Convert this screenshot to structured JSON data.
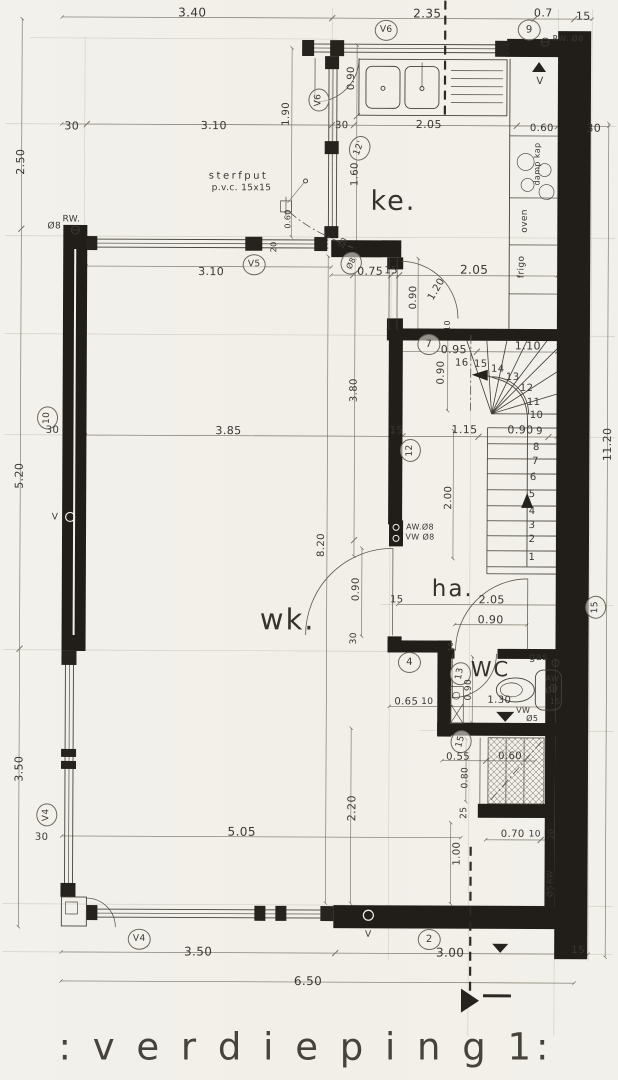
{
  "title": ": v e r d i e p i n g  1:",
  "colors": {
    "paper": "#f2f0ea",
    "ink": "#3a3734",
    "wall": "#211e1a",
    "dim": "#7a7468",
    "faint": "#b3ac9b",
    "line": "#45413a"
  },
  "plan": {
    "labels": [
      {
        "t": "3.40",
        "x": 190,
        "y": 13,
        "fs": 12
      },
      {
        "t": "2.35",
        "x": 425,
        "y": 13,
        "fs": 12
      },
      {
        "t": "0.7",
        "x": 541,
        "y": 12,
        "fs": 11
      },
      {
        "t": "15",
        "x": 581,
        "y": 15,
        "fs": 11
      },
      {
        "t": "9",
        "x": 527,
        "y": 29,
        "fs": 10,
        "c": true,
        "n": "ref-bubble-9"
      },
      {
        "t": "RW. Ø8",
        "x": 566,
        "y": 38,
        "fs": 8,
        "n": "rw-pipe-label"
      },
      {
        "t": "V6",
        "x": 384,
        "y": 30,
        "fs": 9,
        "c": true,
        "n": "window-tag-v6"
      },
      {
        "t": "V",
        "x": 538,
        "y": 81,
        "fs": 10,
        "n": "vent-label"
      },
      {
        "t": "0.90",
        "x": 350,
        "y": 78,
        "r": -90,
        "fs": 10
      },
      {
        "t": "V6",
        "x": 317,
        "y": 100,
        "r": -90,
        "fs": 9,
        "c": true,
        "n": "window-tag-v6"
      },
      {
        "t": "2.50",
        "x": 19,
        "y": 163,
        "r": -90,
        "fs": 11
      },
      {
        "t": "30",
        "x": 70,
        "y": 127,
        "fs": 11
      },
      {
        "t": "3.10",
        "x": 212,
        "y": 126,
        "fs": 11
      },
      {
        "t": "1.90",
        "x": 285,
        "y": 114,
        "r": -90,
        "fs": 10
      },
      {
        "t": "30",
        "x": 340,
        "y": 126,
        "fs": 10
      },
      {
        "t": "2.05",
        "x": 427,
        "y": 124,
        "fs": 11
      },
      {
        "t": "0.60",
        "x": 540,
        "y": 128,
        "fs": 10
      },
      {
        "t": "30",
        "x": 592,
        "y": 127,
        "fs": 11
      },
      {
        "t": "12'",
        "x": 358,
        "y": 148,
        "r": -70,
        "fs": 9,
        "c": true,
        "n": "ref-bubble-12"
      },
      {
        "t": "1.60",
        "x": 354,
        "y": 174,
        "r": -90,
        "fs": 10
      },
      {
        "t": "ke.",
        "x": 392,
        "y": 201,
        "fs": 27,
        "n": "room-label-ke",
        "cls": "room"
      },
      {
        "t": "damp kap",
        "x": 536,
        "y": 163,
        "r": -90,
        "fs": 8,
        "n": "appliance-dampkap"
      },
      {
        "t": "oven",
        "x": 524,
        "y": 220,
        "r": -90,
        "fs": 9,
        "n": "appliance-oven"
      },
      {
        "t": "frigo",
        "x": 521,
        "y": 266,
        "r": -90,
        "fs": 9,
        "n": "appliance-frigo"
      },
      {
        "t": "sterfput",
        "x": 237,
        "y": 177,
        "fs": 10,
        "cls": "sp",
        "n": "sterfput-label"
      },
      {
        "t": "p.v.c. 15x15",
        "x": 240,
        "y": 189,
        "fs": 9,
        "n": "sterfput-spec"
      },
      {
        "t": "RW.",
        "x": 70,
        "y": 221,
        "fs": 9,
        "n": "rw-pipe-label"
      },
      {
        "t": "Ø8",
        "x": 53,
        "y": 228,
        "fs": 9
      },
      {
        "t": "V5",
        "x": 253,
        "y": 265,
        "fs": 9,
        "c": true,
        "n": "window-tag-v5"
      },
      {
        "t": "3.10",
        "x": 210,
        "y": 272,
        "fs": 11
      },
      {
        "t": "0.60",
        "x": 287,
        "y": 219,
        "r": -90,
        "fs": 8
      },
      {
        "t": "20",
        "x": 273,
        "y": 247,
        "r": -90,
        "fs": 8
      },
      {
        "t": "20",
        "x": 342,
        "y": 243,
        "r": -65,
        "fs": 8
      },
      {
        "t": "Ø8",
        "x": 350,
        "y": 263,
        "r": -65,
        "fs": 8,
        "c": true,
        "n": "ref-bubble-o8"
      },
      {
        "t": "0.75",
        "x": 369,
        "y": 271,
        "fs": 11
      },
      {
        "t": "15",
        "x": 390,
        "y": 271,
        "fs": 10
      },
      {
        "t": "0.90",
        "x": 413,
        "y": 297,
        "r": -90,
        "fs": 10
      },
      {
        "t": "1.20",
        "x": 436,
        "y": 289,
        "r": -60,
        "fs": 10
      },
      {
        "t": "2.05",
        "x": 473,
        "y": 269,
        "fs": 12
      },
      {
        "t": "10",
        "x": 447,
        "y": 325,
        "r": -90,
        "fs": 8
      },
      {
        "t": "7",
        "x": 428,
        "y": 344,
        "fs": 10,
        "c": true,
        "n": "ref-bubble-7"
      },
      {
        "t": "0.95",
        "x": 453,
        "y": 349,
        "fs": 11
      },
      {
        "t": "1.10",
        "x": 527,
        "y": 345,
        "fs": 11
      },
      {
        "t": "16",
        "x": 461,
        "y": 363,
        "fs": 10,
        "n": "stair-step-number"
      },
      {
        "t": "15",
        "x": 480,
        "y": 364,
        "fs": 10,
        "n": "stair-step-number"
      },
      {
        "t": "14",
        "x": 497,
        "y": 369,
        "fs": 10,
        "n": "stair-step-number"
      },
      {
        "t": "13",
        "x": 512,
        "y": 377,
        "fs": 10,
        "n": "stair-step-number"
      },
      {
        "t": "12",
        "x": 526,
        "y": 388,
        "fs": 10,
        "n": "stair-step-number"
      },
      {
        "t": "11",
        "x": 533,
        "y": 402,
        "fs": 10,
        "n": "stair-step-number"
      },
      {
        "t": "10",
        "x": 536,
        "y": 415,
        "fs": 10,
        "n": "stair-step-number"
      },
      {
        "t": "0.90",
        "x": 441,
        "y": 372,
        "r": -90,
        "fs": 10
      },
      {
        "t": "15",
        "x": 396,
        "y": 431,
        "fs": 10
      },
      {
        "t": "1.15",
        "x": 464,
        "y": 429,
        "fs": 11
      },
      {
        "t": "0.90",
        "x": 520,
        "y": 429,
        "fs": 11
      },
      {
        "t": "9",
        "x": 539,
        "y": 431,
        "fs": 10,
        "n": "stair-step-number"
      },
      {
        "t": "8",
        "x": 536,
        "y": 447,
        "fs": 10,
        "n": "stair-step-number"
      },
      {
        "t": "7",
        "x": 535,
        "y": 461,
        "fs": 10,
        "n": "stair-step-number"
      },
      {
        "t": "6",
        "x": 533,
        "y": 477,
        "fs": 10,
        "n": "stair-step-number"
      },
      {
        "t": "5",
        "x": 532,
        "y": 494,
        "fs": 10,
        "n": "stair-step-number"
      },
      {
        "t": "4",
        "x": 532,
        "y": 511,
        "fs": 10,
        "n": "stair-step-number"
      },
      {
        "t": "3",
        "x": 532,
        "y": 525,
        "fs": 10,
        "n": "stair-step-number"
      },
      {
        "t": "2",
        "x": 532,
        "y": 539,
        "fs": 10,
        "n": "stair-step-number"
      },
      {
        "t": "1",
        "x": 532,
        "y": 557,
        "fs": 10,
        "n": "stair-step-number"
      },
      {
        "t": "12",
        "x": 410,
        "y": 450,
        "r": -90,
        "fs": 9,
        "c": true,
        "n": "ref-bubble-12b"
      },
      {
        "t": "11.20",
        "x": 607,
        "y": 443,
        "r": -90,
        "fs": 11
      },
      {
        "t": "3.80",
        "x": 354,
        "y": 390,
        "r": -90,
        "fs": 10
      },
      {
        "t": "3.85",
        "x": 228,
        "y": 431,
        "fs": 11
      },
      {
        "t": "10",
        "x": 47,
        "y": 419,
        "r": -90,
        "fs": 9,
        "c": true,
        "n": "ref-bubble-10"
      },
      {
        "t": "30",
        "x": 52,
        "y": 432,
        "fs": 10
      },
      {
        "t": "5.20",
        "x": 19,
        "y": 477,
        "r": -90,
        "fs": 11
      },
      {
        "t": "V",
        "x": 55,
        "y": 519,
        "fs": 9,
        "n": "vent-label"
      },
      {
        "t": "2.00",
        "x": 449,
        "y": 497,
        "r": -90,
        "fs": 10
      },
      {
        "t": "AW.Ø8",
        "x": 420,
        "y": 527,
        "fs": 8,
        "n": "pipe-aw-label"
      },
      {
        "t": "VW Ø8",
        "x": 420,
        "y": 537,
        "fs": 8,
        "n": "pipe-vw-label"
      },
      {
        "t": "8.20",
        "x": 322,
        "y": 545,
        "r": -90,
        "fs": 10
      },
      {
        "t": "0.90",
        "x": 357,
        "y": 589,
        "r": -90,
        "fs": 10
      },
      {
        "t": "wk.",
        "x": 288,
        "y": 620,
        "fs": 29,
        "n": "room-label-wk",
        "cls": "room"
      },
      {
        "t": "ha.",
        "x": 453,
        "y": 589,
        "fs": 23,
        "n": "room-label-ha",
        "cls": "room"
      },
      {
        "t": "15",
        "x": 397,
        "y": 600,
        "fs": 10
      },
      {
        "t": "2.05",
        "x": 492,
        "y": 599,
        "fs": 11
      },
      {
        "t": "0.90",
        "x": 491,
        "y": 619,
        "fs": 11
      },
      {
        "t": "15",
        "x": 596,
        "y": 606,
        "r": -90,
        "fs": 9,
        "c": true,
        "n": "ref-bubble-15"
      },
      {
        "t": "30",
        "x": 355,
        "y": 638,
        "r": -90,
        "fs": 9
      },
      {
        "t": "4",
        "x": 410,
        "y": 662,
        "fs": 10,
        "c": true,
        "n": "ref-bubble-4"
      },
      {
        "t": "13",
        "x": 461,
        "y": 673,
        "r": -80,
        "fs": 9,
        "c": true,
        "n": "ref-bubble-13"
      },
      {
        "t": "WC",
        "x": 491,
        "y": 669,
        "fs": 21,
        "n": "room-label-wc",
        "cls": "room"
      },
      {
        "t": "gas",
        "x": 539,
        "y": 657,
        "fs": 10,
        "n": "gas-label"
      },
      {
        "t": "AW",
        "x": 553,
        "y": 678,
        "fs": 8
      },
      {
        "t": "Ø8",
        "x": 552,
        "y": 690,
        "fs": 8
      },
      {
        "t": "15",
        "x": 556,
        "y": 701,
        "fs": 8
      },
      {
        "t": "0.90",
        "x": 470,
        "y": 689,
        "r": -90,
        "fs": 9
      },
      {
        "t": "1.30",
        "x": 500,
        "y": 700,
        "fs": 10
      },
      {
        "t": "VW",
        "x": 524,
        "y": 710,
        "fs": 8,
        "n": "pipe-vw-label"
      },
      {
        "t": "Ø5",
        "x": 533,
        "y": 718,
        "fs": 8
      },
      {
        "t": "0.65",
        "x": 407,
        "y": 702,
        "fs": 10
      },
      {
        "t": "10",
        "x": 428,
        "y": 702,
        "fs": 9
      },
      {
        "t": "10",
        "x": 452,
        "y": 646,
        "r": -90,
        "fs": 7
      },
      {
        "t": "15",
        "x": 462,
        "y": 741,
        "r": -75,
        "fs": 9,
        "c": true,
        "n": "ref-bubble-15b"
      },
      {
        "t": "0.55",
        "x": 459,
        "y": 757,
        "fs": 10
      },
      {
        "t": "0.60",
        "x": 511,
        "y": 756,
        "fs": 10
      },
      {
        "t": "0.80",
        "x": 467,
        "y": 777,
        "r": -90,
        "fs": 9
      },
      {
        "t": "25",
        "x": 466,
        "y": 812,
        "r": -90,
        "fs": 9
      },
      {
        "t": "0.70",
        "x": 514,
        "y": 834,
        "fs": 10
      },
      {
        "t": "10",
        "x": 536,
        "y": 834,
        "fs": 9
      },
      {
        "t": "20",
        "x": 553,
        "y": 833,
        "r": -90,
        "fs": 8
      },
      {
        "t": "1.00",
        "x": 459,
        "y": 853,
        "r": -90,
        "fs": 10
      },
      {
        "t": "RW",
        "x": 552,
        "y": 876,
        "r": -90,
        "fs": 8,
        "n": "rw-pipe-label"
      },
      {
        "t": "Ø5",
        "x": 552,
        "y": 890,
        "r": -90,
        "fs": 8
      },
      {
        "t": "2.20",
        "x": 353,
        "y": 808,
        "r": -90,
        "fs": 11
      },
      {
        "t": "5.05",
        "x": 243,
        "y": 832,
        "fs": 12
      },
      {
        "t": "3.50",
        "x": 20,
        "y": 770,
        "r": -90,
        "fs": 11
      },
      {
        "t": "V4",
        "x": 48,
        "y": 816,
        "r": -90,
        "fs": 9,
        "c": true,
        "n": "window-tag-v4"
      },
      {
        "t": "30",
        "x": 43,
        "y": 839,
        "fs": 10
      },
      {
        "t": "V4",
        "x": 141,
        "y": 940,
        "fs": 9,
        "c": true,
        "n": "window-tag-v4"
      },
      {
        "t": "V",
        "x": 370,
        "y": 935,
        "fs": 9,
        "n": "vent-label"
      },
      {
        "t": "2",
        "x": 431,
        "y": 939,
        "fs": 10,
        "c": true,
        "n": "ref-bubble-2"
      },
      {
        "t": "3.50",
        "x": 200,
        "y": 952,
        "fs": 12
      },
      {
        "t": "3.00",
        "x": 452,
        "y": 952,
        "fs": 12
      },
      {
        "t": "15",
        "x": 580,
        "y": 950,
        "fs": 10
      },
      {
        "t": "6.50",
        "x": 310,
        "y": 981,
        "fs": 12
      }
    ]
  }
}
